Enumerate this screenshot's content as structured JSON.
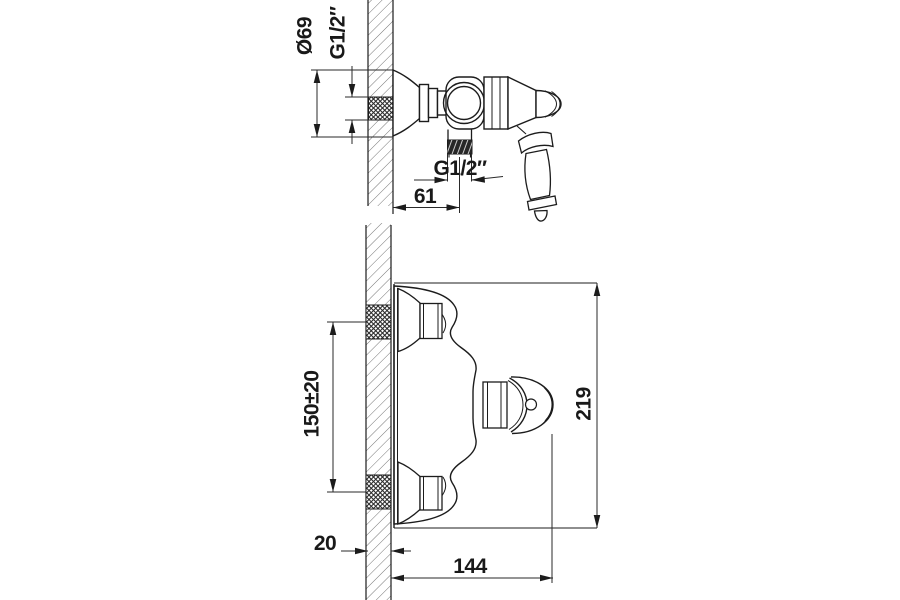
{
  "canvas": {
    "background": "#ffffff",
    "ink": "#1c1c1c",
    "hatch_color": "#757575"
  },
  "drawing": {
    "kind": "technical-dimension-drawing",
    "subject": "wall-mounted faucet / shower mixer, two orthographic views"
  },
  "dims": {
    "escutcheon_diameter": "Ø69",
    "wall_thread": "G1/2″",
    "outlet_thread": "G1/2″",
    "wall_to_outlet": "61",
    "inlet_spacing": "150±20",
    "overall_length": "219",
    "wall_thickness": "20",
    "projection": "144"
  }
}
